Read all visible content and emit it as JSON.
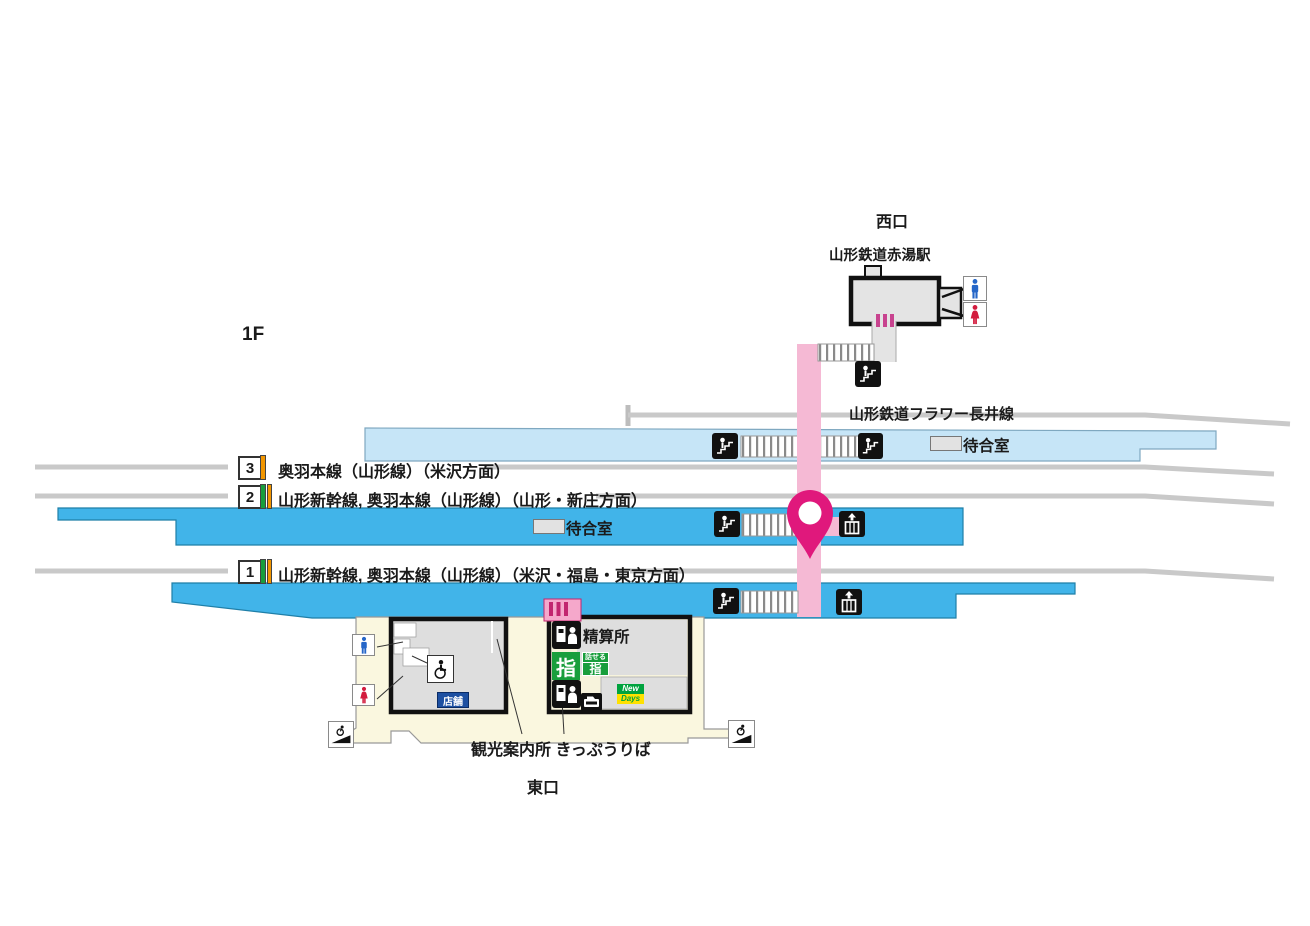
{
  "floor": {
    "label": "1F"
  },
  "west": {
    "exit_label": "西口",
    "station_name": "山形鉄道赤湯駅"
  },
  "flower": {
    "line_name": "山形鉄道フラワー長井線"
  },
  "shared": {
    "waiting_room": "待合室"
  },
  "platforms": [
    {
      "number": "3",
      "lines": "奥羽本線（山形線）（米沢方面）"
    },
    {
      "number": "2",
      "lines": "山形新幹線, 奥羽本線（山形線）（山形・新庄方面）"
    },
    {
      "number": "1",
      "lines": "山形新幹線, 奥羽本線（山形線）（米沢・福島・東京方面）"
    }
  ],
  "facilities": {
    "fare_adjustment": "精算所",
    "reserved_seat": "指",
    "talkable_label": "話せる",
    "talkable_seat": "指",
    "shop": "店舗",
    "newdays_top": "New",
    "newdays_bottom": "Days"
  },
  "labels": {
    "tourist_info_tickets": "観光案内所 きっぷうりば",
    "east_exit": "東口"
  },
  "colors": {
    "platform_blue": "#41B4E9",
    "platform_lightblue": "#C6E5F7",
    "route_pink": "#F5B9D4",
    "gate_pink": "#C2256F",
    "pin_magenta": "#E0187C",
    "concourse_cream": "#FAF7DF",
    "stripe_green": "#189E3C",
    "stripe_orange": "#F29600",
    "shop_blue": "#1D50A2",
    "newdays_green": "#00A33E",
    "newdays_yellow": "#FFE100",
    "male_blue": "#2566C8",
    "female_red": "#D31C3E"
  }
}
